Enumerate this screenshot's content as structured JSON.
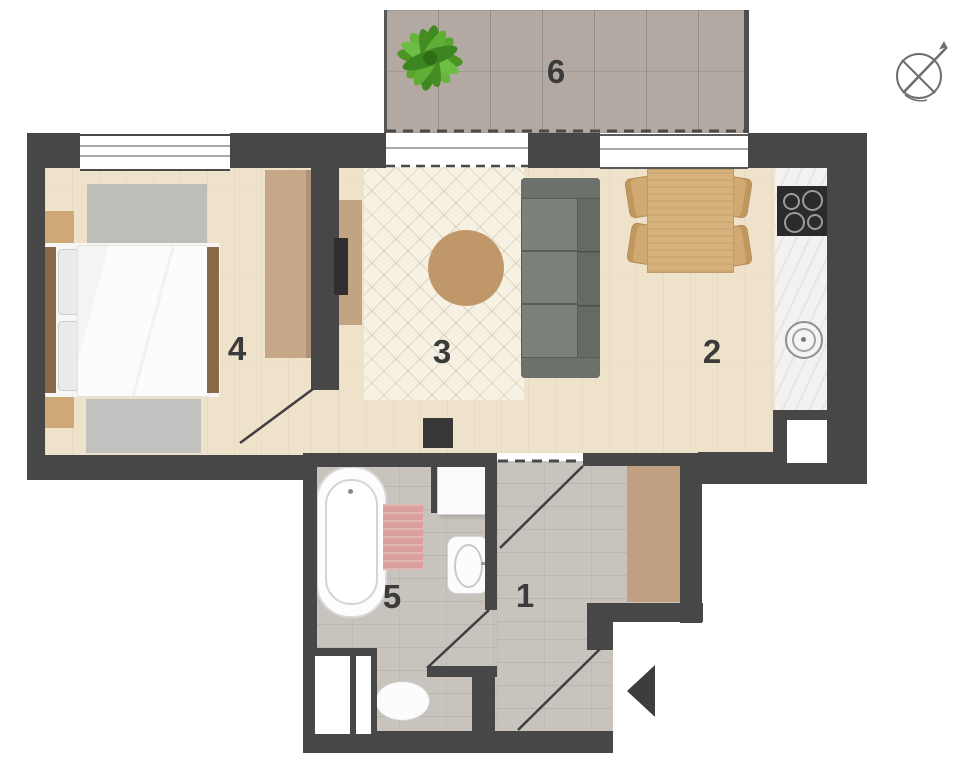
{
  "plan": {
    "rooms": [
      {
        "id": "hallway",
        "label": "1"
      },
      {
        "id": "kitchen-dining",
        "label": "2"
      },
      {
        "id": "living-area",
        "label": "3"
      },
      {
        "id": "bedroom",
        "label": "4"
      },
      {
        "id": "bathroom",
        "label": "5"
      },
      {
        "id": "balcony",
        "label": "6"
      }
    ],
    "icons": {
      "compass": "north-arrow-compass",
      "entrance_arrow": "entrance-direction-arrow",
      "plant": "potted-plant"
    },
    "colors": {
      "wall": "#474747",
      "wood_floor": "#efe2cb",
      "tile_floor": "#c8c3bc",
      "balcony_tile": "#b2aaa2",
      "rug_cream": "#f6f1e3",
      "rug_gray": "#bdbdba",
      "rug_pink": "#d9a09e",
      "sofa_gray": "#6e746d",
      "wood_furniture": "#d1a973",
      "wardrobe_tan": "#c6a788",
      "counter_white": "#f3f2f0",
      "fixture_white": "#fcfcfc",
      "cooktop_black": "#2b2b2b",
      "plant_green": "#58a52f",
      "label_color": "#3b3b3b"
    }
  }
}
